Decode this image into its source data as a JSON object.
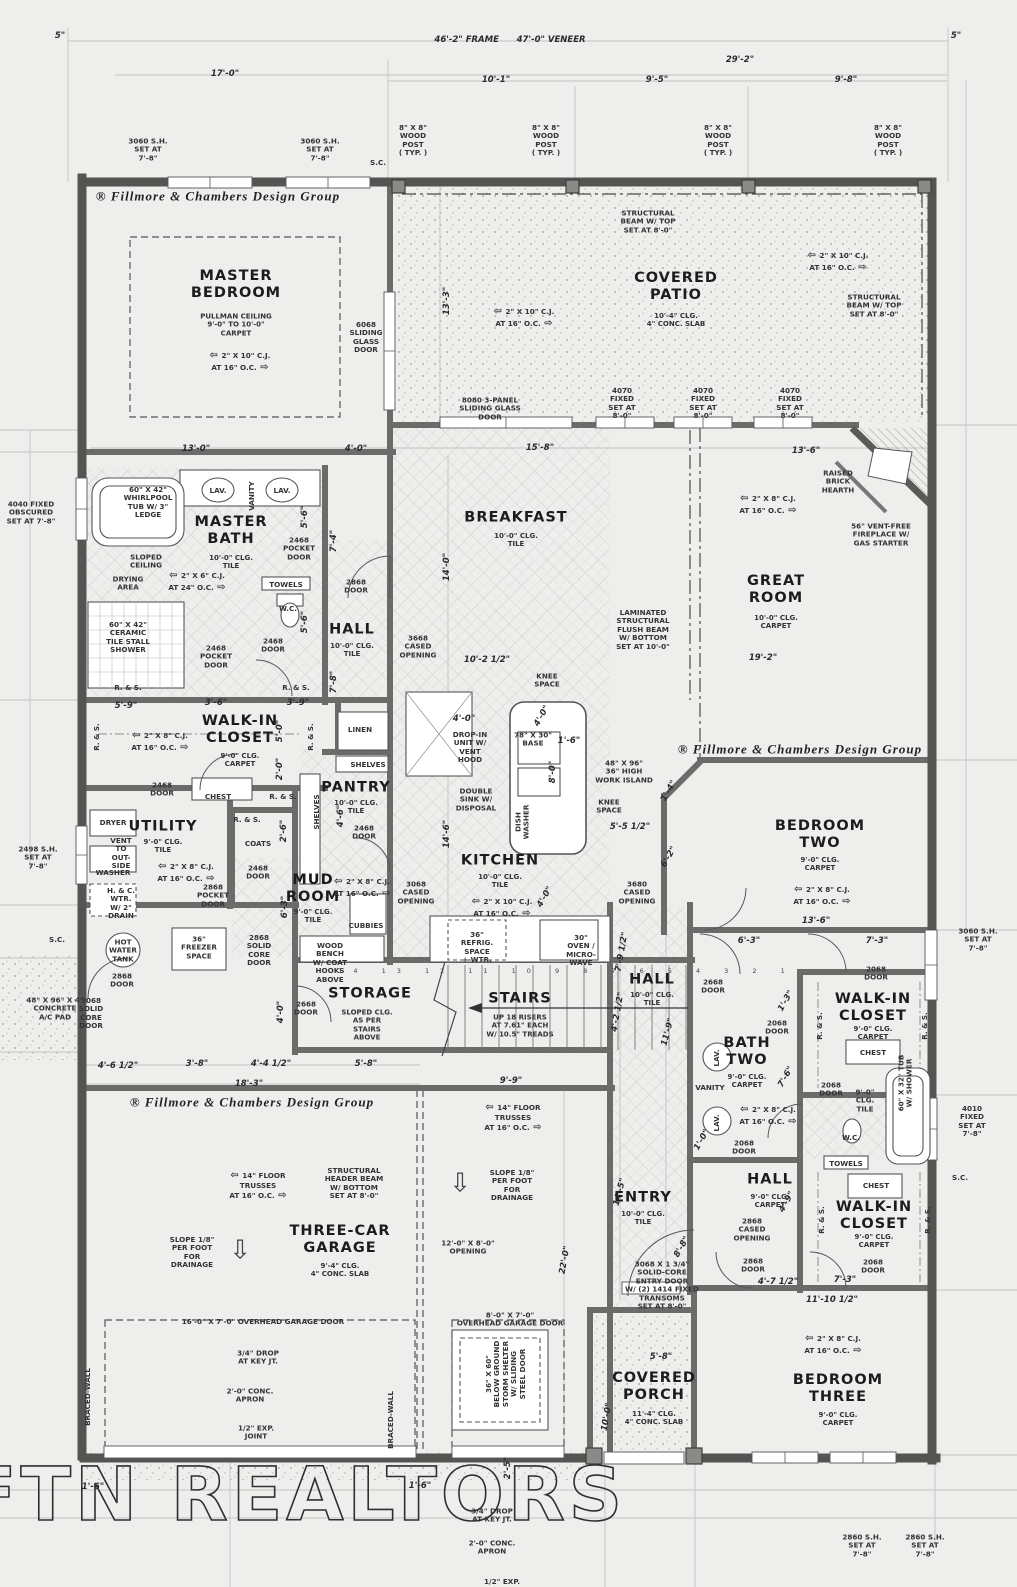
{
  "watermark": "FTN REALTORS",
  "colors": {
    "paper": "#eeefed",
    "wall_dark": "#565656",
    "wall_mid": "#6b6b6b",
    "construction_line": "#c3c3c3",
    "ink": "#2e2e2e"
  },
  "branding": {
    "text": "® Fillmore & Chambers Design Group",
    "instances": [
      {
        "x": 218,
        "y": 196
      },
      {
        "x": 800,
        "y": 749
      },
      {
        "x": 252,
        "y": 1102
      }
    ]
  },
  "rooms": [
    {
      "name": "MASTER\nBEDROOM",
      "sub": "PULLMAN CEILING\n9'-0\" TO 10'-0\"\nCARPET",
      "x": 236,
      "y": 285,
      "sx": 236,
      "sy": 325
    },
    {
      "name": "COVERED\nPATIO",
      "sub": "10'-4\" CLG.\n4\" CONC. SLAB",
      "x": 676,
      "y": 287,
      "sx": 676,
      "sy": 320
    },
    {
      "name": "MASTER\nBATH",
      "sub": "10'-0\" CLG.\nTILE",
      "x": 231,
      "y": 531,
      "sx": 231,
      "sy": 562
    },
    {
      "name": "HALL",
      "sub": "10'-0\" CLG.\nTILE",
      "x": 352,
      "y": 630,
      "sx": 352,
      "sy": 650
    },
    {
      "name": "BREAKFAST",
      "sub": "10'-0\" CLG.\nTILE",
      "x": 516,
      "y": 518,
      "sx": 516,
      "sy": 540
    },
    {
      "name": "GREAT\nROOM",
      "sub": "10'-0\" CLG.\nCARPET",
      "x": 776,
      "y": 590,
      "sx": 776,
      "sy": 622
    },
    {
      "name": "WALK-IN\nCLOSET",
      "sub": "9'-0\" CLG.\nCARPET",
      "x": 240,
      "y": 730,
      "sx": 240,
      "sy": 760
    },
    {
      "name": "PANTRY",
      "sub": "10'-0\" CLG.\nTILE",
      "x": 356,
      "y": 788,
      "sx": 356,
      "sy": 807
    },
    {
      "name": "UTILITY",
      "sub": "9'-0\" CLG.\nTILE",
      "x": 163,
      "y": 827,
      "sx": 163,
      "sy": 846
    },
    {
      "name": "MUD\nROOM",
      "sub": "9'-0\" CLG.\nTILE",
      "x": 313,
      "y": 889,
      "sx": 313,
      "sy": 916
    },
    {
      "name": "KITCHEN",
      "sub": "10'-0\" CLG.\nTILE",
      "x": 500,
      "y": 861,
      "sx": 500,
      "sy": 881
    },
    {
      "name": "BEDROOM\nTWO",
      "sub": "9'-0\" CLG.\nCARPET",
      "x": 820,
      "y": 835,
      "sx": 820,
      "sy": 864
    },
    {
      "name": "STORAGE",
      "sub": "SLOPED CLG.\nAS PER\nSTAIRS\nABOVE",
      "x": 370,
      "y": 994,
      "sx": 367,
      "sy": 1025
    },
    {
      "name": "STAIRS",
      "sub": "UP 18 RISERS\nAT 7.61\" EACH\nW/ 10.5\" TREADS",
      "x": 520,
      "y": 999,
      "sx": 520,
      "sy": 1026
    },
    {
      "name": "HALL",
      "sub": "10'-0\" CLG.\nTILE",
      "x": 652,
      "y": 980,
      "sx": 652,
      "sy": 999
    },
    {
      "name": "BATH\nTWO",
      "sub": "9'-0\" CLG.\nCARPET",
      "x": 747,
      "y": 1052,
      "sx": 747,
      "sy": 1081
    },
    {
      "name": "WALK-IN\nCLOSET",
      "sub": "9'-0\" CLG.\nCARPET",
      "x": 873,
      "y": 1008,
      "sx": 873,
      "sy": 1033
    },
    {
      "name": "THREE-CAR\nGARAGE",
      "sub": "9'-4\" CLG.\n4\" CONC. SLAB",
      "x": 340,
      "y": 1240,
      "sx": 340,
      "sy": 1270
    },
    {
      "name": "ENTRY",
      "sub": "10'-0\" CLG.\nTILE",
      "x": 643,
      "y": 1198,
      "sx": 643,
      "sy": 1218
    },
    {
      "name": "HALL",
      "sub": "9'-0\" CLG.\nCARPET",
      "x": 770,
      "y": 1180,
      "sx": 770,
      "sy": 1201
    },
    {
      "name": "WALK-IN\nCLOSET",
      "sub": "9'-0\" CLG.\nCARPET",
      "x": 874,
      "y": 1216,
      "sx": 874,
      "sy": 1241
    },
    {
      "name": "COVERED\nPORCH",
      "sub": "11'-4\" CLG.\n4\" CONC. SLAB",
      "x": 654,
      "y": 1387,
      "sx": 654,
      "sy": 1418
    },
    {
      "name": "BEDROOM\nTHREE",
      "sub": "9'-0\" CLG.\nCARPET",
      "x": 838,
      "y": 1389,
      "sx": 838,
      "sy": 1419
    }
  ],
  "annotations": [
    {
      "t": "3060 S.H.\nSET AT\n7'-8\"",
      "x": 148,
      "y": 150
    },
    {
      "t": "3060 S.H.\nSET AT\n7'-8\"",
      "x": 320,
      "y": 150
    },
    {
      "t": "S.C.",
      "x": 378,
      "y": 163
    },
    {
      "t": "8\" X 8\"\nWOOD\nPOST\n( TYP. )",
      "x": 413,
      "y": 141
    },
    {
      "t": "8\" X 8\"\nWOOD\nPOST\n( TYP. )",
      "x": 546,
      "y": 141
    },
    {
      "t": "8\" X 8\"\nWOOD\nPOST\n( TYP. )",
      "x": 718,
      "y": 141
    },
    {
      "t": "8\" X 8\"\nWOOD\nPOST\n( TYP. )",
      "x": 888,
      "y": 141
    },
    {
      "t": "STRUCTURAL\nBEAM W/ TOP\nSET AT 8'-0\"",
      "x": 648,
      "y": 222
    },
    {
      "t": "2\" X 10\" C.J.\nAT 16\" O.C.",
      "x": 240,
      "y": 362,
      "cj": true
    },
    {
      "t": "2\" X 10\" C.J.\nAT 16\" O.C.",
      "x": 524,
      "y": 318,
      "cj": true
    },
    {
      "t": "2\" X 10\" C.J.\nAT 16\" O.C.",
      "x": 838,
      "y": 262,
      "cj": true
    },
    {
      "t": "STRUCTURAL\nBEAM W/ TOP\nSET AT 8'-0\"",
      "x": 874,
      "y": 306
    },
    {
      "t": "6068\nSLIDING\nGLASS\nDOOR",
      "x": 366,
      "y": 338
    },
    {
      "t": "8080 3-PANEL\nSLIDING GLASS\nDOOR",
      "x": 490,
      "y": 409
    },
    {
      "t": "4070\nFIXED\nSET AT\n8'-0\"",
      "x": 622,
      "y": 404
    },
    {
      "t": "4070\nFIXED\nSET AT\n8'-0\"",
      "x": 703,
      "y": 404
    },
    {
      "t": "4070\nFIXED\nSET AT\n8'-0\"",
      "x": 790,
      "y": 404
    },
    {
      "t": "RAISED\nBRICK\nHEARTH",
      "x": 838,
      "y": 482
    },
    {
      "t": "56\" VENT-FREE\nFIREPLACE W/\nGAS STARTER",
      "x": 881,
      "y": 535
    },
    {
      "t": "2\" X 8\" C.J.\nAT 16\" O.C.",
      "x": 768,
      "y": 505,
      "cj": true
    },
    {
      "t": "60\" X 42\"\nWHIRLPOOL\nTUB W/ 3\"\nLEDGE",
      "x": 148,
      "y": 503
    },
    {
      "t": "LAV.",
      "x": 218,
      "y": 491
    },
    {
      "t": "LAV.",
      "x": 282,
      "y": 491
    },
    {
      "t": "VANITY",
      "x": 252,
      "y": 496,
      "r": -90
    },
    {
      "t": "2468\nPOCKET\nDOOR",
      "x": 299,
      "y": 549
    },
    {
      "t": "SLOPED\nCEILING",
      "x": 146,
      "y": 562
    },
    {
      "t": "DRYING\nAREA",
      "x": 128,
      "y": 584
    },
    {
      "t": "2\" X 6\" C.J.\nAT 24\" O.C.",
      "x": 197,
      "y": 582,
      "cj": true
    },
    {
      "t": "TOWELS",
      "x": 286,
      "y": 585
    },
    {
      "t": "W.C.",
      "x": 288,
      "y": 609
    },
    {
      "t": "60\" X 42\"\nCERAMIC\nTILE STALL\nSHOWER",
      "x": 128,
      "y": 638
    },
    {
      "t": "2468\nPOCKET\nDOOR",
      "x": 216,
      "y": 657
    },
    {
      "t": "2468\nDOOR",
      "x": 273,
      "y": 646
    },
    {
      "t": "2868\nDOOR",
      "x": 356,
      "y": 587
    },
    {
      "t": "LAMINATED\nSTRUCTURAL\nFLUSH BEAM\nW/ BOTTOM\nSET AT 10'-0\"",
      "x": 643,
      "y": 630
    },
    {
      "t": "3668\nCASED\nOPENING",
      "x": 418,
      "y": 647
    },
    {
      "t": "KNEE\nSPACE",
      "x": 547,
      "y": 681
    },
    {
      "t": "KNEE\nSPACE",
      "x": 609,
      "y": 807
    },
    {
      "t": "R. & S.",
      "x": 128,
      "y": 688
    },
    {
      "t": "R. & S.",
      "x": 296,
      "y": 688
    },
    {
      "t": "R. & S.",
      "x": 97,
      "y": 737,
      "r": -90
    },
    {
      "t": "R. & S.",
      "x": 311,
      "y": 737,
      "r": -90
    },
    {
      "t": "R. & S.",
      "x": 283,
      "y": 797
    },
    {
      "t": "R. & S.",
      "x": 247,
      "y": 820
    },
    {
      "t": "2\" X 8\" C.J.\nAT 16\" O.C.",
      "x": 160,
      "y": 742,
      "cj": true
    },
    {
      "t": "2468\nDOOR",
      "x": 162,
      "y": 790
    },
    {
      "t": "CHEST",
      "x": 218,
      "y": 797
    },
    {
      "t": "LINEN",
      "x": 360,
      "y": 730
    },
    {
      "t": "SHELVES",
      "x": 368,
      "y": 765
    },
    {
      "t": "SHELVES",
      "x": 317,
      "y": 812,
      "r": -90
    },
    {
      "t": "2468\nDOOR",
      "x": 364,
      "y": 833
    },
    {
      "t": "DRYER",
      "x": 113,
      "y": 823
    },
    {
      "t": "VENT\nTO\nOUT-\nSIDE",
      "x": 121,
      "y": 854
    },
    {
      "t": "WASHER",
      "x": 113,
      "y": 873
    },
    {
      "t": "H. & C.\nWTR.\nW/ 2\"\nDRAIN",
      "x": 121,
      "y": 904
    },
    {
      "t": "COATS",
      "x": 258,
      "y": 844
    },
    {
      "t": "2468\nDOOR",
      "x": 258,
      "y": 873
    },
    {
      "t": "2\" X 8\" C.J.\nAT 16\" O.C.",
      "x": 186,
      "y": 873,
      "cj": true
    },
    {
      "t": "2868\nPOCKET\nDOOR",
      "x": 213,
      "y": 896
    },
    {
      "t": "HOT\nWATER\nTANK",
      "x": 123,
      "y": 951
    },
    {
      "t": "36\"\nFREEZER\nSPACE",
      "x": 199,
      "y": 948
    },
    {
      "t": "2868\nSOLID\nCORE\nDOOR",
      "x": 259,
      "y": 951
    },
    {
      "t": "CUBBIES",
      "x": 366,
      "y": 926
    },
    {
      "t": "WOOD\nBENCH\nW/ COAT\nHOOKS\nABOVE",
      "x": 330,
      "y": 963
    },
    {
      "t": "2\" X 8\" C.J.\nAT 16\" O.C.",
      "x": 362,
      "y": 888,
      "cj": true
    },
    {
      "t": "DROP-IN\nUNIT W/\nVENT\nHOOD",
      "x": 470,
      "y": 748
    },
    {
      "t": "78\" X 30\"\nBASE",
      "x": 533,
      "y": 740
    },
    {
      "t": "DOUBLE\nSINK W/\nDISPOSAL",
      "x": 476,
      "y": 800
    },
    {
      "t": "DISH\nWASHER",
      "x": 523,
      "y": 822,
      "r": -90
    },
    {
      "t": "48\" X 96\"\n36\" HIGH\nWORK ISLAND",
      "x": 624,
      "y": 772
    },
    {
      "t": "3068\nCASED\nOPENING",
      "x": 416,
      "y": 893
    },
    {
      "t": "2\" X 10\" C.J.\nAT 16\" O.C.",
      "x": 502,
      "y": 908,
      "cj": true
    },
    {
      "t": "3680\nCASED\nOPENING",
      "x": 637,
      "y": 893
    },
    {
      "t": "36\"\nREFRIG.\nSPACE\n+ WTR.",
      "x": 477,
      "y": 948
    },
    {
      "t": "30\"\nOVEN /\nMICRO-\nWAVE",
      "x": 581,
      "y": 951
    },
    {
      "t": "2\" X 8\" C.J.\nAT 16\" O.C.",
      "x": 822,
      "y": 896,
      "cj": true
    },
    {
      "t": "3060 S.H.\nSET AT\n7'-8\"",
      "x": 978,
      "y": 940
    },
    {
      "t": "2668\nDOOR",
      "x": 306,
      "y": 1009
    },
    {
      "t": "14 13 12 11 10 9 8 7 6 5 4 3 2 1",
      "x": 567,
      "y": 972,
      "cls": "tiny",
      "n": "stair-tread-numbers"
    },
    {
      "t": "2668\nDOOR",
      "x": 713,
      "y": 987
    },
    {
      "t": "2068\nDOOR",
      "x": 876,
      "y": 974
    },
    {
      "t": "R. & S.",
      "x": 820,
      "y": 1026,
      "r": -90
    },
    {
      "t": "R. & S.",
      "x": 925,
      "y": 1026,
      "r": -90
    },
    {
      "t": "2068\nDOOR",
      "x": 777,
      "y": 1028
    },
    {
      "t": "CHEST",
      "x": 873,
      "y": 1053
    },
    {
      "t": "VANITY",
      "x": 710,
      "y": 1088
    },
    {
      "t": "LAV.",
      "x": 717,
      "y": 1058,
      "r": -90
    },
    {
      "t": "LAV.",
      "x": 717,
      "y": 1123,
      "r": -90
    },
    {
      "t": "2\" X 8\" C.J.\nAT 16\" O.C.",
      "x": 768,
      "y": 1116,
      "cj": true
    },
    {
      "t": "2068\nDOOR",
      "x": 831,
      "y": 1090
    },
    {
      "t": "9'-0\"\nCLG.\nTILE",
      "x": 865,
      "y": 1101
    },
    {
      "t": "60\" X 32\" TUB\nW/ SHOWER",
      "x": 906,
      "y": 1083,
      "r": -90
    },
    {
      "t": "W.C.",
      "x": 851,
      "y": 1138
    },
    {
      "t": "TOWELS",
      "x": 846,
      "y": 1164
    },
    {
      "t": "2068\nDOOR",
      "x": 744,
      "y": 1148
    },
    {
      "t": "4010\nFIXED\nSET AT\n7'-8\"",
      "x": 972,
      "y": 1122
    },
    {
      "t": "S.C.",
      "x": 960,
      "y": 1178
    },
    {
      "t": "S.C.",
      "x": 57,
      "y": 940
    },
    {
      "t": "CHEST",
      "x": 876,
      "y": 1186
    },
    {
      "t": "R. & S.",
      "x": 822,
      "y": 1220,
      "r": -90
    },
    {
      "t": "R. & S.",
      "x": 928,
      "y": 1220,
      "r": -90
    },
    {
      "t": "2868\nCASED\nOPENING",
      "x": 752,
      "y": 1230
    },
    {
      "t": "2868\nDOOR",
      "x": 753,
      "y": 1266
    },
    {
      "t": "2068\nDOOR",
      "x": 873,
      "y": 1267
    },
    {
      "t": "14\" FLOOR\nTRUSSES\nAT 16\" O.C.",
      "x": 258,
      "y": 1186,
      "cj": true
    },
    {
      "t": "STRUCTURAL\nHEADER BEAM\nW/ BOTTOM\nSET AT 8'-0\"",
      "x": 354,
      "y": 1184
    },
    {
      "t": "SLOPE 1/8\"\nPER FOOT\nFOR\nDRAINAGE",
      "x": 192,
      "y": 1253
    },
    {
      "t": "⇩",
      "x": 240,
      "y": 1251,
      "cls": "arrow",
      "n": "drainage-slope-arrow"
    },
    {
      "t": "14\" FLOOR\nTRUSSES\nAT 16\" O.C.",
      "x": 513,
      "y": 1118,
      "cj": true
    },
    {
      "t": "SLOPE 1/8\"\nPER FOOT\nFOR\nDRAINAGE",
      "x": 512,
      "y": 1186
    },
    {
      "t": "⇩",
      "x": 460,
      "y": 1184,
      "cls": "arrow",
      "n": "drainage-slope-arrow"
    },
    {
      "t": "16'-0\" X 7'-0\" OVERHEAD GARAGE DOOR",
      "x": 263,
      "y": 1322
    },
    {
      "t": "12'-0\" X 8'-0\"\nOPENING",
      "x": 468,
      "y": 1248
    },
    {
      "t": "8'-0\" X 7'-0\"\nOVERHEAD GARAGE DOOR",
      "x": 510,
      "y": 1320
    },
    {
      "t": "36\" X 60\"\nBELOW GROUND\nSTORM SHELTER\nW/ SLIDING\nSTEEL DOOR",
      "x": 506,
      "y": 1374,
      "r": -90
    },
    {
      "t": "3/4\" DROP\nAT KEY JT.",
      "x": 258,
      "y": 1358
    },
    {
      "t": "2'-0\" CONC.\nAPRON",
      "x": 250,
      "y": 1396
    },
    {
      "t": "1/2\" EXP.\nJOINT",
      "x": 256,
      "y": 1433
    },
    {
      "t": "BRACED-WALL",
      "x": 88,
      "y": 1397,
      "r": -90
    },
    {
      "t": "BRACED-WALL",
      "x": 391,
      "y": 1420,
      "r": -90
    },
    {
      "t": "3068 X 1 3/4\"\nSOLID-CORE\nENTRY DOOR\nW/ (2) 1414 FIXED\nTRANSOMS\nSET AT 8'-0\"",
      "x": 662,
      "y": 1286
    },
    {
      "t": "2860 S.H.\nSET AT\n7'-8\"",
      "x": 862,
      "y": 1546
    },
    {
      "t": "2860 S.H.\nSET AT\n7'-8\"",
      "x": 925,
      "y": 1546
    },
    {
      "t": "4040 FIXED\nOBSCURED\nSET AT 7'-8\"",
      "x": 31,
      "y": 513
    },
    {
      "t": "2498 S.H.\nSET AT\n7'-8\"",
      "x": 38,
      "y": 858
    },
    {
      "t": "48\" X 96\" X 4\"\nCONCRETE\nA/C PAD",
      "x": 55,
      "y": 1009
    },
    {
      "t": "3068\nSOLID\nCORE\nDOOR",
      "x": 91,
      "y": 1014
    },
    {
      "t": "2868\nDOOR",
      "x": 122,
      "y": 981
    },
    {
      "t": "3/4\" DROP\nAT KEY JT.",
      "x": 492,
      "y": 1516
    },
    {
      "t": "2'-0\" CONC.\nAPRON",
      "x": 492,
      "y": 1548
    },
    {
      "t": "1/2\" EXP.",
      "x": 502,
      "y": 1582
    },
    {
      "t": "2\" X 8\" C.J.\nAT 16\" O.C.",
      "x": 833,
      "y": 1345,
      "cj": true
    }
  ],
  "dimensions": [
    {
      "t": "5\"",
      "x": 60,
      "y": 36
    },
    {
      "t": "46'-2\" FRAME      47'-0\" VENEER",
      "x": 510,
      "y": 40
    },
    {
      "t": "5\"",
      "x": 956,
      "y": 36
    },
    {
      "t": "17'-0\"",
      "x": 225,
      "y": 74
    },
    {
      "t": "29'-2\"",
      "x": 740,
      "y": 60
    },
    {
      "t": "10'-1\"",
      "x": 496,
      "y": 80
    },
    {
      "t": "9'-5\"",
      "x": 657,
      "y": 80
    },
    {
      "t": "9'-8\"",
      "x": 846,
      "y": 80
    },
    {
      "t": "13'-0\"",
      "x": 196,
      "y": 449
    },
    {
      "t": "4'-0\"",
      "x": 356,
      "y": 449
    },
    {
      "t": "13'-3\"",
      "x": 447,
      "y": 301,
      "r": -90
    },
    {
      "t": "15'-8\"",
      "x": 540,
      "y": 448
    },
    {
      "t": "13'-6\"",
      "x": 806,
      "y": 451
    },
    {
      "t": "5'-6\"",
      "x": 305,
      "y": 517,
      "r": -90
    },
    {
      "t": "7'-4\"",
      "x": 334,
      "y": 541,
      "r": -90
    },
    {
      "t": "5'-6\"",
      "x": 305,
      "y": 622,
      "r": -90
    },
    {
      "t": "7'-8\"",
      "x": 334,
      "y": 682,
      "r": -90
    },
    {
      "t": "5'-9\"",
      "x": 126,
      "y": 706
    },
    {
      "t": "3'-6\"",
      "x": 216,
      "y": 703
    },
    {
      "t": "3'-9\"",
      "x": 298,
      "y": 703
    },
    {
      "t": "14'-0\"",
      "x": 447,
      "y": 567,
      "r": -90
    },
    {
      "t": "10'-2 1/2\"",
      "x": 487,
      "y": 660
    },
    {
      "t": "19'-2\"",
      "x": 763,
      "y": 658
    },
    {
      "t": "5'-0\"",
      "x": 280,
      "y": 731,
      "r": -90
    },
    {
      "t": "2'-0\"",
      "x": 280,
      "y": 769,
      "r": -90
    },
    {
      "t": "4'-6\"",
      "x": 341,
      "y": 816,
      "r": -90
    },
    {
      "t": "2'-6\"",
      "x": 284,
      "y": 831,
      "r": -90
    },
    {
      "t": "6'-3\"",
      "x": 285,
      "y": 907,
      "r": -90
    },
    {
      "t": "4'-0\"",
      "x": 464,
      "y": 719
    },
    {
      "t": "4'-0\"",
      "x": 542,
      "y": 716,
      "r": -60
    },
    {
      "t": "1'-6\"",
      "x": 569,
      "y": 741
    },
    {
      "t": "8'-0\"",
      "x": 553,
      "y": 772,
      "r": -90
    },
    {
      "t": "1'-4\"",
      "x": 669,
      "y": 791,
      "r": -60
    },
    {
      "t": "5'-5 1/2\"",
      "x": 630,
      "y": 827
    },
    {
      "t": "6'-2\"",
      "x": 669,
      "y": 857,
      "r": -60
    },
    {
      "t": "14'-6\"",
      "x": 447,
      "y": 834,
      "r": -90
    },
    {
      "t": "4'-0\"",
      "x": 545,
      "y": 897,
      "r": -60
    },
    {
      "t": "13'-6\"",
      "x": 816,
      "y": 921
    },
    {
      "t": "6'-3\"",
      "x": 749,
      "y": 941
    },
    {
      "t": "7'-3\"",
      "x": 877,
      "y": 941
    },
    {
      "t": "7'-9 1/2\"",
      "x": 622,
      "y": 952,
      "r": -80
    },
    {
      "t": "4'-2 1/2\"",
      "x": 618,
      "y": 1012,
      "r": -80
    },
    {
      "t": "11'-9\"",
      "x": 668,
      "y": 1032,
      "r": -75
    },
    {
      "t": "4'-0\"",
      "x": 281,
      "y": 1012,
      "r": -90
    },
    {
      "t": "4'-6 1/2\"",
      "x": 118,
      "y": 1066
    },
    {
      "t": "3'-8\"",
      "x": 197,
      "y": 1064
    },
    {
      "t": "4'-4 1/2\"",
      "x": 271,
      "y": 1064
    },
    {
      "t": "5'-8\"",
      "x": 366,
      "y": 1064
    },
    {
      "t": "18'-3\"",
      "x": 249,
      "y": 1084
    },
    {
      "t": "9'-9\"",
      "x": 511,
      "y": 1081
    },
    {
      "t": "1'-3\"",
      "x": 786,
      "y": 1001,
      "r": -60
    },
    {
      "t": "7'-6\"",
      "x": 786,
      "y": 1077,
      "r": -60
    },
    {
      "t": "1'-0\"",
      "x": 702,
      "y": 1140,
      "r": -60
    },
    {
      "t": "14'-5\"",
      "x": 620,
      "y": 1192,
      "r": -75
    },
    {
      "t": "8'-8\"",
      "x": 682,
      "y": 1247,
      "r": -60
    },
    {
      "t": "4'-9\"",
      "x": 787,
      "y": 1202,
      "r": -60
    },
    {
      "t": "4'-7 1/2\"",
      "x": 778,
      "y": 1282
    },
    {
      "t": "7'-3\"",
      "x": 845,
      "y": 1280
    },
    {
      "t": "11'-10 1/2\"",
      "x": 832,
      "y": 1300
    },
    {
      "t": "22'-0\"",
      "x": 565,
      "y": 1260,
      "r": -80
    },
    {
      "t": "5'-8\"",
      "x": 661,
      "y": 1357
    },
    {
      "t": "10'-0\"",
      "x": 607,
      "y": 1417,
      "r": -80
    },
    {
      "t": "2'-5\"",
      "x": 508,
      "y": 1468,
      "r": -90
    },
    {
      "t": "1'-6\"",
      "x": 93,
      "y": 1487
    },
    {
      "t": "1'-6\"",
      "x": 420,
      "y": 1486
    }
  ]
}
